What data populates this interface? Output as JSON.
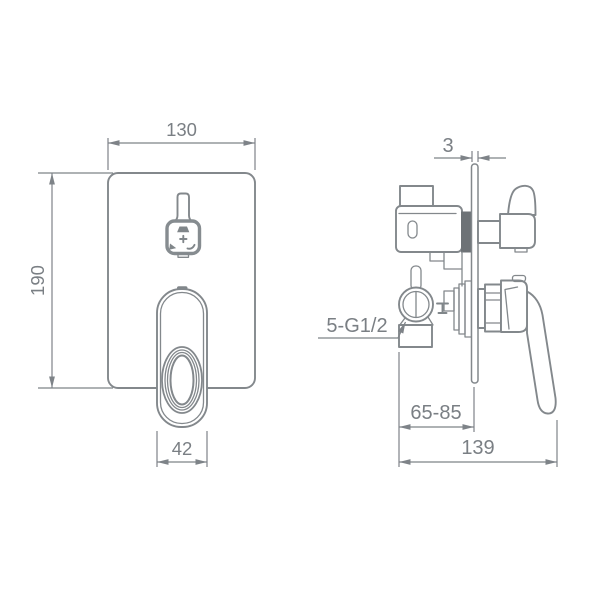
{
  "drawing": {
    "type": "technical-dimension-drawing",
    "subject": "concealed shower mixer valve, front and side views",
    "background": "#ffffff",
    "line_color": "#83888c",
    "text_color": "#7a7f84",
    "dark_fill_color": "#6d7276"
  },
  "front_view": {
    "name": "front view of wall plate with diverter button and lever handle",
    "dim_width": "130",
    "dim_height": "190",
    "dim_handle_width": "42",
    "diverter_icons": [
      "shower-head-icon",
      "plus-icon",
      "handshower-icon",
      "spout-icon"
    ]
  },
  "side_view": {
    "name": "side view of in-wall valve body",
    "dim_plate_thickness": "3",
    "dim_install_depth": "65-85",
    "dim_total_depth": "139",
    "connection_label": "5-G1/2"
  }
}
